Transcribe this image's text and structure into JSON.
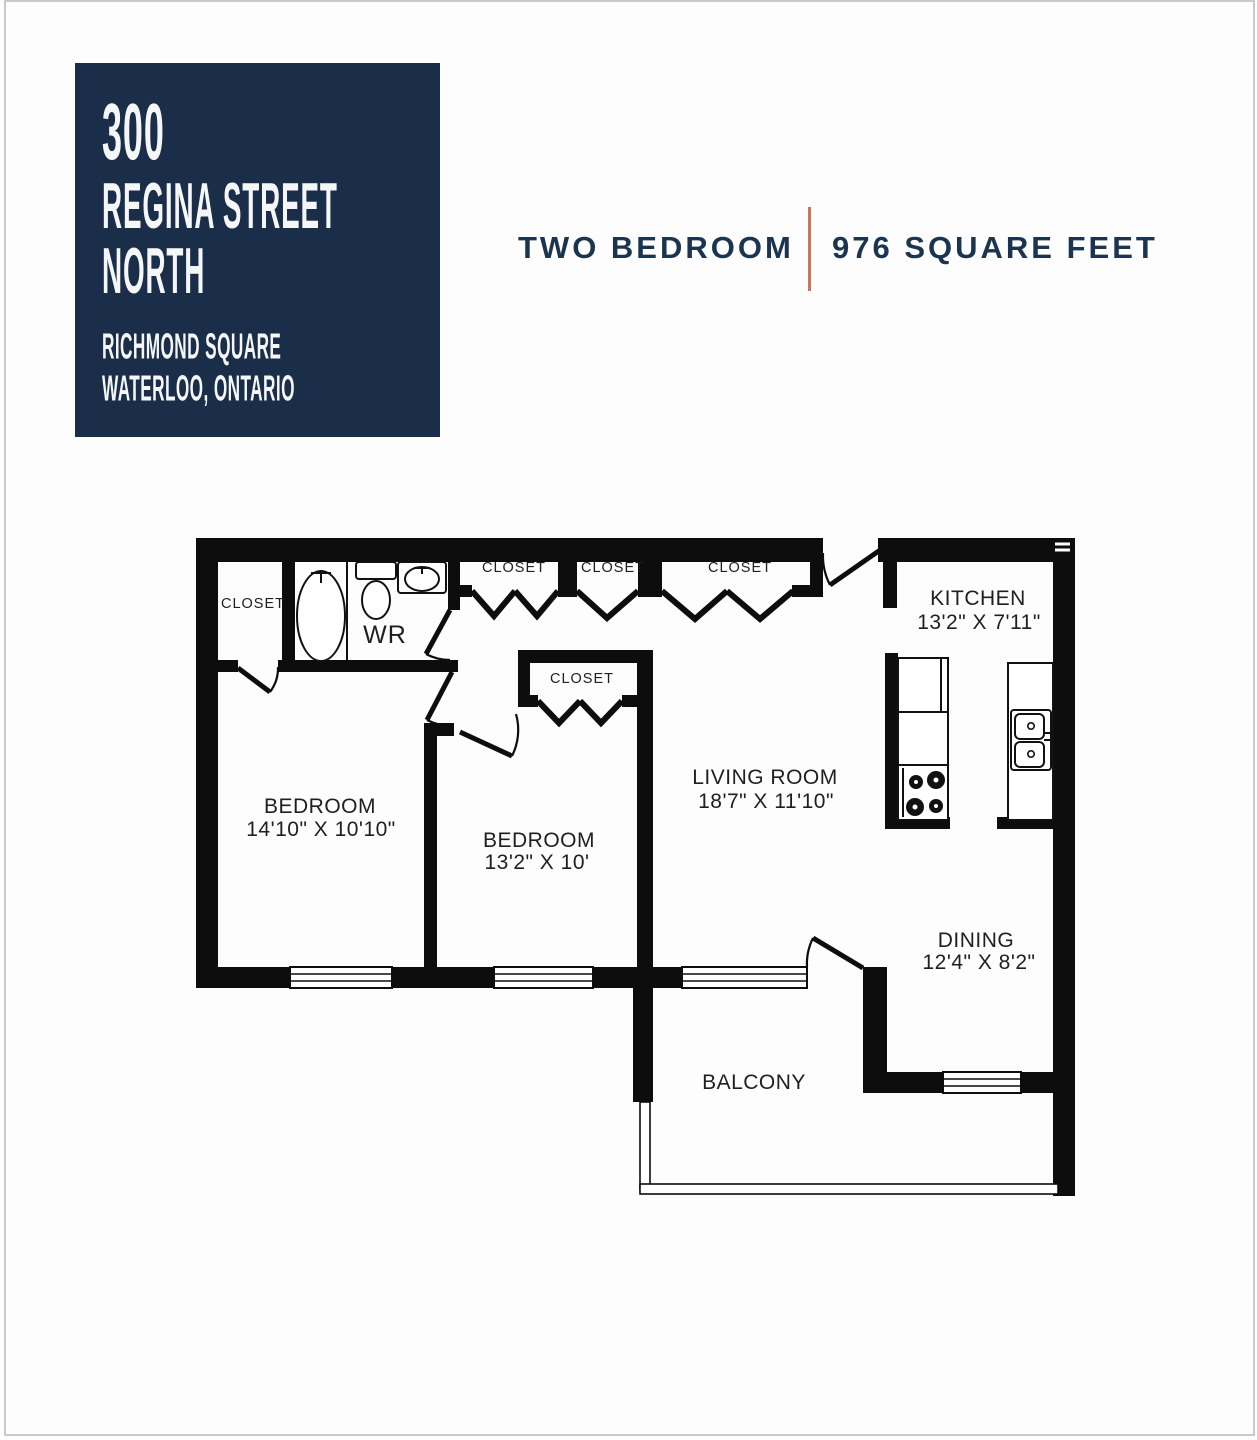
{
  "address_card": {
    "bg_color": "#1a2e49",
    "line1": "300",
    "line2": "REGINA STREET",
    "line3": "NORTH",
    "sub1": "RICHMOND SQUARE",
    "sub2": "WATERLOO, ONTARIO"
  },
  "plan_title": {
    "left": "TWO BEDROOM",
    "right": "976 SQUARE FEET",
    "divider_color": "#c5795a",
    "text_color": "#1b3450"
  },
  "floorplan": {
    "closet_label": "CLOSET",
    "wr_label": "WR",
    "kitchen": {
      "name": "KITCHEN",
      "dims": "13'2\" X 7'11\""
    },
    "living_room": {
      "name": "LIVING ROOM",
      "dims": "18'7\" X 11'10\""
    },
    "dining": {
      "name": "DINING",
      "dims": "12'4\" X 8'2\""
    },
    "bedroom1": {
      "name": "BEDROOM",
      "dims": "14'10\" X 10'10\""
    },
    "bedroom2": {
      "name": "BEDROOM",
      "dims": "13'2\" X 10'"
    },
    "balcony": {
      "name": "BALCONY"
    }
  }
}
